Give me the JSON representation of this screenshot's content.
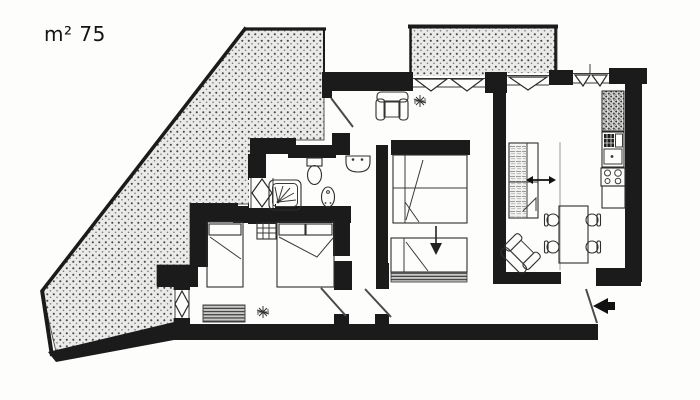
{
  "plan": {
    "area_label": "m² 75",
    "drawing_type": "apartment floor plan",
    "colors": {
      "paper": "#fdfdfc",
      "wall": "#1b1b1b",
      "terrace_fill": "#eaeae8",
      "terrace_dots": "#474747",
      "furniture_line": "#2e2e2e"
    },
    "rooms": [
      {
        "name": "terrace",
        "items": [
          "stippled-paving"
        ]
      },
      {
        "name": "balcony",
        "items": [
          "stippled-paving"
        ]
      },
      {
        "name": "living-area",
        "items": [
          "armchair",
          "plant",
          "terrace-door"
        ]
      },
      {
        "name": "bathroom",
        "items": [
          "shower",
          "toilet",
          "bidet",
          "washbasin",
          "window"
        ]
      },
      {
        "name": "bedroom-1",
        "items": [
          "single-bed",
          "nightstand",
          "double-bed",
          "rug",
          "plant",
          "window"
        ]
      },
      {
        "name": "bedroom-2",
        "items": [
          "double-bed",
          "chest-with-down-arrow",
          "hatched-strip"
        ]
      },
      {
        "name": "kitchen",
        "items": [
          "wardrobe",
          "slide-arrow",
          "refrigerator",
          "sink-unit",
          "cooktop",
          "counter",
          "window"
        ]
      },
      {
        "name": "dining-area",
        "items": [
          "table",
          "chair",
          "chair",
          "chair",
          "chair",
          "rotated-armchair"
        ]
      },
      {
        "name": "entrance",
        "items": [
          "door-swing",
          "entry-arrow"
        ]
      },
      {
        "name": "corridor",
        "items": [
          "door-swing",
          "door-swing"
        ]
      }
    ]
  }
}
